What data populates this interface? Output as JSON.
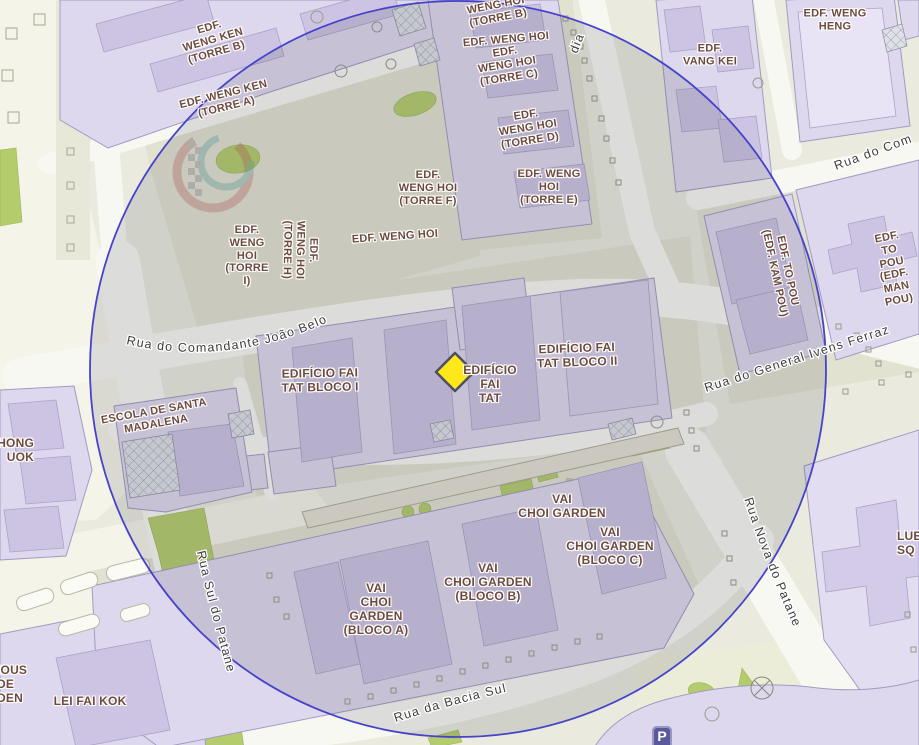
{
  "map": {
    "marker": {
      "shape": "diamond",
      "fill": "#ffe81a",
      "border": "#4d4d66"
    },
    "overlay_circle": {
      "stroke": "#4543cb",
      "fill": "rgba(72,72,80,0.155)"
    },
    "poi": {
      "parking_label": "P"
    },
    "colors": {
      "ground": "#eaebde",
      "road": "#f8f8f3",
      "building": "#ded8ee",
      "building_dark": "#cdc4e3",
      "green": "#b4cc6c",
      "building_label_text": "#6e4a3e",
      "street_label_text": "#3d3d3d"
    },
    "buildings": [
      {
        "text": "EDF.\nWENG KEN\n(TORRE B)"
      },
      {
        "text": "EDF. WENG KEN\n(TORRE A)"
      },
      {
        "text": "WENG HOI\n(TORRE B)"
      },
      {
        "text": "EDF. WENG HOI"
      },
      {
        "text": "EDF.\nWENG HOI\n(TORRE C)"
      },
      {
        "text": "EDF.\nWENG HOI\n(TORRE D)"
      },
      {
        "text": "EDF. WENG\nHOI\n(TORRE E)"
      },
      {
        "text": "EDF.\nWENG HOI\n(TORRE F)"
      },
      {
        "text": "EDF.\nWENG\nHOI\n(TORRE\nI)"
      },
      {
        "text": "EDF.\nWENG HOI\n(TORRE H)"
      },
      {
        "text": "EDF. WENG HOI"
      },
      {
        "text": "EDF.\nVANG KEI"
      },
      {
        "text": "EDF. WENG\nHENG"
      },
      {
        "text": "EDIFÍCIO FAI\nTAT BLOCO I"
      },
      {
        "text": "EDIFÍCIO\nFAI\nTAT"
      },
      {
        "text": "EDIFÍCIO FAI\nTAT BLOCO II"
      },
      {
        "text": "EDF. TO POU\n(EDF. KAM POU)"
      },
      {
        "text": "EDF. TO POU\n(EDF. MAN\nPOU)"
      },
      {
        "text": "VAI\nCHOI GARDEN"
      },
      {
        "text": "VAI\nCHOI GARDEN\n(BLOCO C)"
      },
      {
        "text": "VAI\nCHOI GARDEN\n(BLOCO B)"
      },
      {
        "text": "VAI\nCHOI\nGARDEN\n(BLOCO A)"
      },
      {
        "text": "ESCOLA DE SANTA\nMADALENA"
      },
      {
        "text": "LEI FAI KOK"
      },
      {
        "text": "HONG\nUOK"
      },
      {
        "text": "IOUS\nDE\nDEN"
      },
      {
        "text": "LUE\nSQ"
      }
    ],
    "streets": [
      {
        "text": "Rua do Comandante João Belo"
      },
      {
        "text": "Rua do General Ivens Ferraz"
      },
      {
        "text": "Rua da Bacia Sul"
      },
      {
        "text": "Rua Sul do Patane"
      },
      {
        "text": "Rua Nova do Patane"
      },
      {
        "text": "Rua do Com"
      },
      {
        "text": "dia"
      }
    ]
  }
}
